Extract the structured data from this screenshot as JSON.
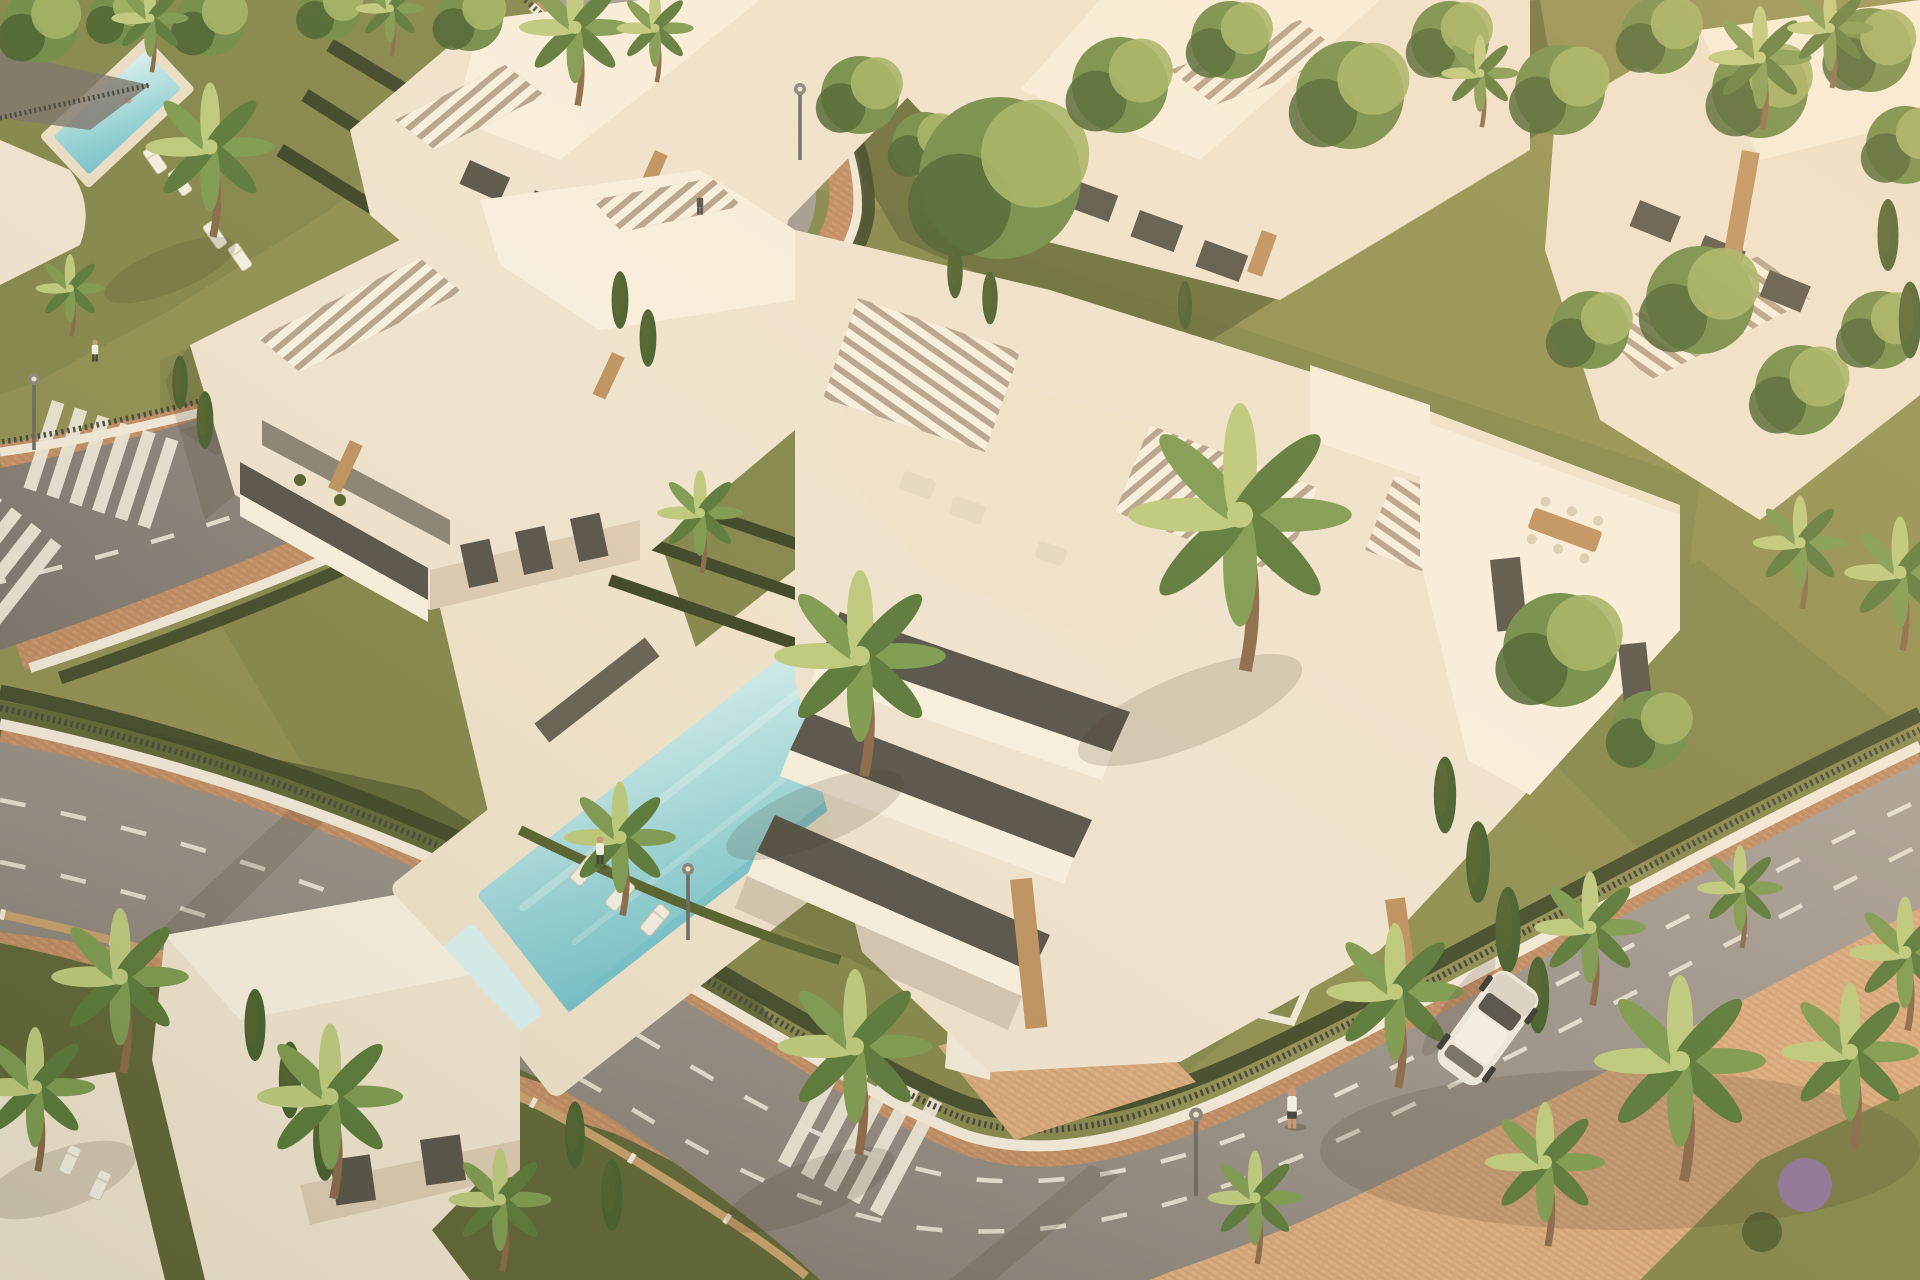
{
  "meta": {
    "title": "aerial-architectural-render",
    "type": "photorealistic-3d-visualization",
    "view": "aerial-oblique",
    "setting": "mediterranean-residential-complex",
    "lighting": "warm-low-sun-from-upper-right"
  },
  "scene": {
    "buildings": {
      "apartment_blocks": 5,
      "villas": 2,
      "max_stories": 4,
      "style": "modern-white-flat-roofs-with-slatted-pergolas-and-wood-accents"
    },
    "amenities": {
      "swimming_pools": 2,
      "main_pool_shape": "rectangular-lap-pool-with-kids-pool",
      "sun_loungers_visible": 14,
      "rooftop_terraces_with_dining": true
    },
    "landscape": {
      "palm_trees": "many",
      "cypress_trees": "many",
      "clipped_dark_hedges": true,
      "lawns": true,
      "flowering_shrub_color": "purple"
    },
    "streets": {
      "roads": 2,
      "lane_markings": "white-dashed",
      "crosswalks": 4,
      "sidewalk_paving": "terracotta-brick",
      "street_lamps": 4
    },
    "objects": {
      "cars": 1,
      "car_color": "white",
      "pedestrians": 4,
      "pool_swimmers": 2
    },
    "infrastructure": {
      "perimeter": "white-walls-with-dark-metal-railing-and-hedges",
      "villa_fence": "wood-lattice-with-white-posts",
      "garage": "underground-entrance-with-green-roof"
    }
  },
  "palette": {
    "bg": "#8f8f52",
    "grass-sun": "#9a9a5e",
    "grass-mid": "#83874c",
    "grass-dark": "#5f6637",
    "hedge-dark": "#3c4629",
    "hedge-mid": "#55622f",
    "tree-green": "#6f8c49",
    "tree-light": "#a0b264",
    "tree-dark": "#46602f",
    "palm-green": "#7d9b52",
    "palm-light": "#bcca7e",
    "palm-dark": "#5a7a3b",
    "trunk": "#8a6a4a",
    "bldg-bright": "#f8f0e0",
    "bldg-light": "#efe4d0",
    "bldg-mid": "#dccbb3",
    "bldg-shadow": "#b5a48f",
    "deck-cream": "#eee3cc",
    "glass": "#57544a",
    "glass-light": "#8b8374",
    "wood": "#bd9260",
    "pool-light": "#d8f1f2",
    "pool-mid": "#9cd6da",
    "pool-deep": "#74c2cc",
    "asphalt-light": "#a8a199",
    "asphalt": "#948d85",
    "asphalt-dark": "#7a746d",
    "road-mark": "#ece7d9",
    "brick": "#c18e66",
    "brick-light": "#d7a97d",
    "brick-dark": "#a87a52",
    "wall-white": "#f1e9da",
    "fence-dark": "#45463d",
    "lattice": "#c6a06c",
    "car-body": "#ece8dd",
    "car-glass": "#55534b",
    "skin": "#c69a78",
    "shirt": "#f4f1e8",
    "pants": "#3e3e38",
    "shadow": "rgba(61,52,34,0.30)",
    "shadow-soft": "rgba(61,52,34,0.16)",
    "flower": "#a083bb"
  }
}
